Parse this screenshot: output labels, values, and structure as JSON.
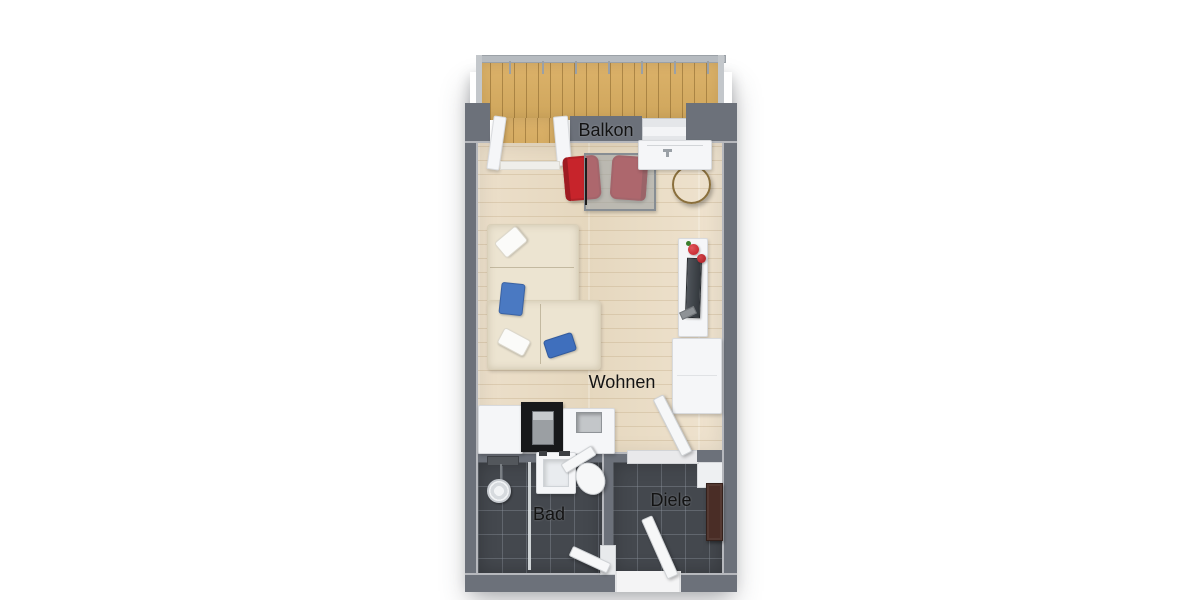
{
  "floorplan": {
    "rooms": {
      "balkon": {
        "label": "Balkon"
      },
      "wohnen": {
        "label": "Wohnen"
      },
      "bad": {
        "label": "Bad"
      },
      "diele": {
        "label": "Diele"
      }
    },
    "palette": {
      "background": "#ffffff",
      "wall_gray": "#6c717a",
      "wood_floor": "#e9dcc6",
      "balcony_deck": "#d4aa60",
      "dark_tile": "#44484e",
      "white_furniture": "#f5f6f8",
      "sofa_cream": "#ece4d1",
      "pillow_blue": "#4a79c2",
      "accent_red": "#c7242b",
      "hall_cabinet_brown": "#4a2d26"
    },
    "furniture": [
      "balcony-railing",
      "balcony-door",
      "corner-sofa",
      "pillows",
      "dining-table",
      "dining-chairs",
      "floor-lamp",
      "round-side-table",
      "kitchen-sink-counter",
      "kitchenette-counter",
      "oven-cabinet",
      "tv-lowboard",
      "tv",
      "wardrobe",
      "interior-door",
      "shower",
      "glass-partition",
      "bathroom-sink",
      "toilet",
      "bathroom-door",
      "hallway-cabinet",
      "entrance-door"
    ]
  }
}
